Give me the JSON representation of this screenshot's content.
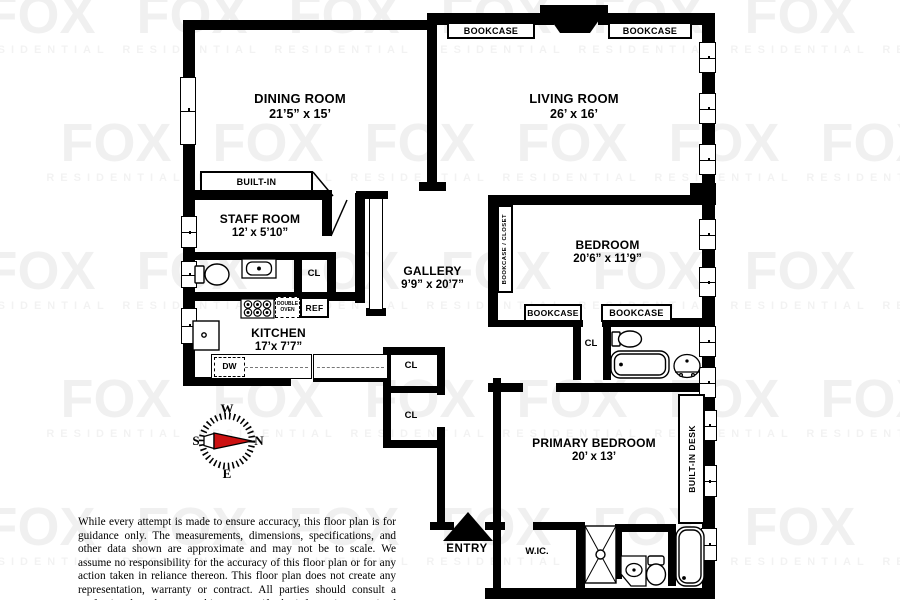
{
  "watermark": {
    "brand": "FOX",
    "sub": "RESIDENTIAL"
  },
  "rooms": {
    "dining": {
      "name": "DINING ROOM",
      "dims": "21’5” x  15’"
    },
    "living": {
      "name": "LIVING ROOM",
      "dims": "26’  x  16’"
    },
    "staff": {
      "name": "STAFF ROOM",
      "dims": "12’  x  5’10”"
    },
    "gallery": {
      "name": "GALLERY",
      "dims": "9’9” x  20’7”"
    },
    "bedroom": {
      "name": "BEDROOM",
      "dims": "20’6” x  11’9”"
    },
    "kitchen": {
      "name": "KITCHEN",
      "dims": "17’x  7’7”"
    },
    "primary": {
      "name": "PRIMARY BEDROOM",
      "dims": "20’  x  13’"
    },
    "wic": {
      "name": "W.IC."
    }
  },
  "labels": {
    "bookcase": "BOOKCASE",
    "built_in": "BUILT-IN",
    "bookcase_closet": "BOOKCASE / CLOSET",
    "built_in_desk": "BUILT-IN DESK",
    "closet": "CL",
    "ref": "REF",
    "double_oven": "DOUBLE OVEN",
    "dw": "DW",
    "entry": "ENTRY"
  },
  "compass": {
    "n": "N",
    "s": "S",
    "e": "E",
    "w": "W",
    "needle_color": "#cc1111"
  },
  "disclaimer": "While every attempt is made to ensure accuracy, this floor plan is for guidance only. The measurements, dimensions, specifications, and other data shown are approximate and may not be to scale.  We assume no responsibility for the accuracy of this floor plan or for any action taken in reliance thereon. This floor plan does not create any representation, warranty or contract. All parties should consult a professional, such as an architect, to verify the information contained herein.",
  "colors": {
    "wall": "#000000",
    "background": "#ffffff",
    "needle": "#cc1111"
  }
}
